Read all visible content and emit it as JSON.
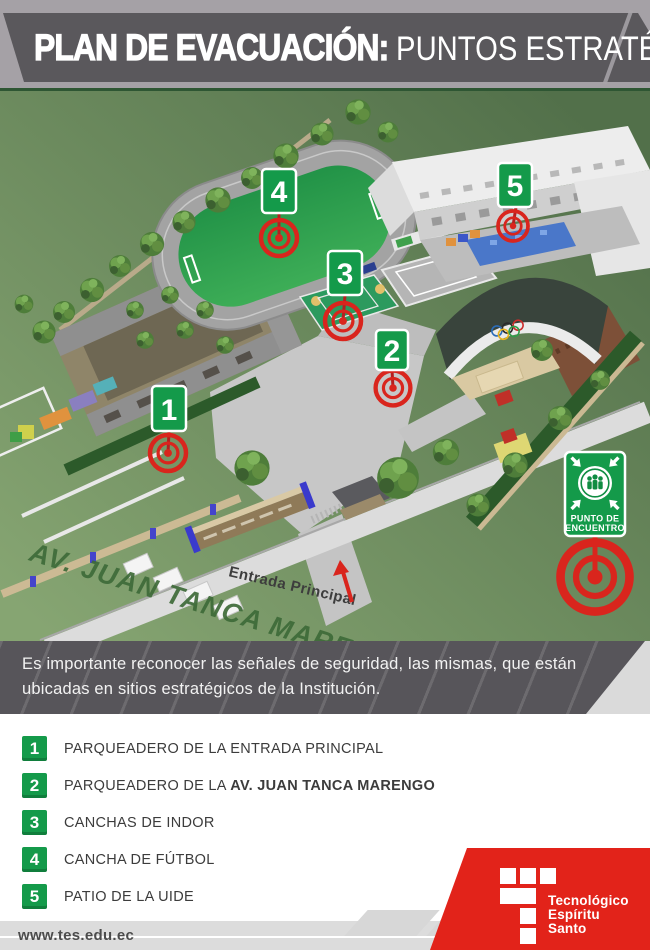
{
  "header": {
    "title_bold": "PLAN DE EVACUACIÓN:",
    "title_light": "PUNTOS ESTRATÉGICOS"
  },
  "map": {
    "street_label": "AV. JUAN TANCA MARENGO",
    "entrance_label": "Entrada Principal",
    "meeting_point_sign": {
      "line1": "PUNTO DE",
      "line2": "ENCUENTRO"
    },
    "markers": [
      {
        "number": "1"
      },
      {
        "number": "2"
      },
      {
        "number": "3"
      },
      {
        "number": "4"
      },
      {
        "number": "5"
      }
    ],
    "icons": {
      "meeting_point": "people-gathering-icon",
      "marker_target": "red-target-icon",
      "entrance_pointer": "red-arrow-icon",
      "coliseum_decoration": "olympic-rings-icon"
    }
  },
  "info": {
    "text": "Es importante reconocer las señales de seguridad, las mismas, que están ubicadas en sitios estratégicos de la Institución."
  },
  "legend": {
    "items": [
      {
        "number": "1",
        "text": "PARQUEADERO DE LA ENTRADA PRINCIPAL",
        "bold": ""
      },
      {
        "number": "2",
        "text": "PARQUEADERO DE LA ",
        "bold": "AV. JUAN TANCA MARENGO"
      },
      {
        "number": "3",
        "text": "CANCHAS DE INDOR",
        "bold": ""
      },
      {
        "number": "4",
        "text": "CANCHA DE FÚTBOL",
        "bold": ""
      },
      {
        "number": "5",
        "text": "PATIO DE LA UIDE",
        "bold": ""
      }
    ]
  },
  "footer": {
    "url": "www.tes.edu.ec",
    "logo": {
      "line1": "Tecnológico",
      "line2": "Espíritu",
      "line3": "Santo"
    }
  },
  "colors": {
    "sign_green": "#149a4a",
    "target_red": "#d9251d",
    "logo_red": "#e2231a",
    "title_bar_gray": "#5a585c",
    "info_bar_gray": "#57555a",
    "map_green_dark": "#52704a",
    "map_green_light": "#86a572"
  }
}
